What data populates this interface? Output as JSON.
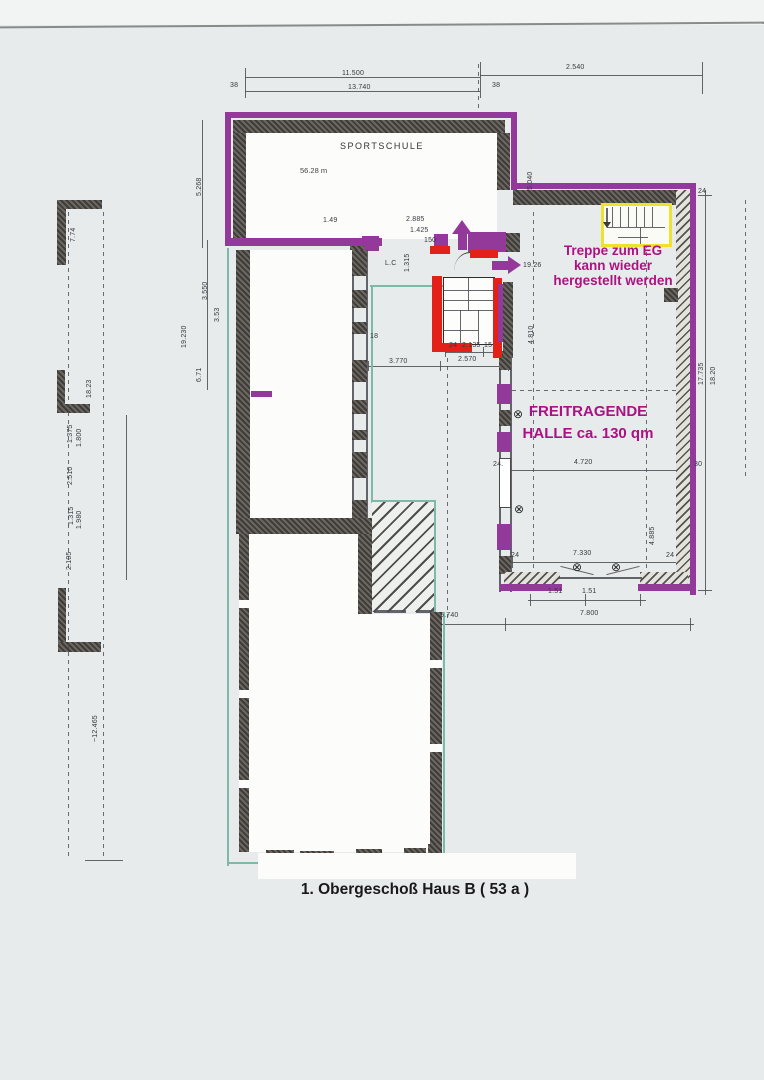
{
  "labels": {
    "room_sportschule": "SPORTSCHULE",
    "room_sportschule_area": "56.28 m",
    "treppe_line1": "Treppe zum EG",
    "treppe_line2": "kann wieder",
    "treppe_line3": "hergestellt werden",
    "halle_line1": "FREITRAGENDE",
    "halle_line2": "HALLE ca. 130 qm",
    "title": "1. Obergeschoß Haus B ( 53 a )"
  },
  "colors": {
    "highlight_purple": "#93399a",
    "annotation_magenta": "#ae1180",
    "highlight_red": "#e32119",
    "highlight_yellow": "#ece22f",
    "outline_teal": "#7db9a9",
    "wall_dark": "#4a4846",
    "paper": "#e8ebec"
  },
  "dimensions": [
    {
      "text": "11.500",
      "x": 342,
      "y": 70
    },
    {
      "text": "13.740",
      "x": 348,
      "y": 84
    },
    {
      "text": "2.540",
      "x": 566,
      "y": 64
    },
    {
      "text": "38",
      "x": 230,
      "y": 82
    },
    {
      "text": "38",
      "x": 492,
      "y": 82
    },
    {
      "text": "5.268",
      "x": 196,
      "y": 196,
      "rot": 1
    },
    {
      "text": "7.74",
      "x": 70,
      "y": 242,
      "rot": 1
    },
    {
      "text": "5.040",
      "x": 527,
      "y": 190,
      "rot": 1
    },
    {
      "text": "1.49",
      "x": 323,
      "y": 217
    },
    {
      "text": "2.885",
      "x": 406,
      "y": 216
    },
    {
      "text": "1.425",
      "x": 410,
      "y": 227
    },
    {
      "text": "150",
      "x": 424,
      "y": 237
    },
    {
      "text": "1.315",
      "x": 404,
      "y": 272,
      "rot": 1
    },
    {
      "text": "L.C",
      "x": 385,
      "y": 260
    },
    {
      "text": "19.26",
      "x": 523,
      "y": 262
    },
    {
      "text": "24",
      "x": 449,
      "y": 342
    },
    {
      "text": "2.135",
      "x": 462,
      "y": 342
    },
    {
      "text": "15",
      "x": 484,
      "y": 342
    },
    {
      "text": "3.770",
      "x": 389,
      "y": 358
    },
    {
      "text": "2.570",
      "x": 458,
      "y": 356
    },
    {
      "text": "18",
      "x": 370,
      "y": 333
    },
    {
      "text": "19.230",
      "x": 181,
      "y": 348,
      "rot": 1
    },
    {
      "text": "3.550",
      "x": 202,
      "y": 300,
      "rot": 1
    },
    {
      "text": "3.53",
      "x": 214,
      "y": 322,
      "rot": 1
    },
    {
      "text": "6.71",
      "x": 196,
      "y": 382,
      "rot": 1
    },
    {
      "text": "18.23",
      "x": 86,
      "y": 398,
      "rot": 1
    },
    {
      "text": "1.375",
      "x": 67,
      "y": 443,
      "rot": 1
    },
    {
      "text": "1.800",
      "x": 76,
      "y": 447,
      "rot": 1
    },
    {
      "text": "2.510",
      "x": 67,
      "y": 485,
      "rot": 1
    },
    {
      "text": "1.315",
      "x": 68,
      "y": 525,
      "rot": 1
    },
    {
      "text": "1.980",
      "x": 76,
      "y": 529,
      "rot": 1
    },
    {
      "text": "2.105",
      "x": 66,
      "y": 570,
      "rot": 1
    },
    {
      "text": "~12.465",
      "x": 92,
      "y": 742,
      "rot": 1
    },
    {
      "text": "17.735",
      "x": 698,
      "y": 385,
      "rot": 1
    },
    {
      "text": "18.20",
      "x": 710,
      "y": 385,
      "rot": 1
    },
    {
      "text": "24",
      "x": 698,
      "y": 188
    },
    {
      "text": "4.810",
      "x": 528,
      "y": 344,
      "rot": 1
    },
    {
      "text": "4.720",
      "x": 574,
      "y": 459
    },
    {
      "text": "24.",
      "x": 493,
      "y": 461
    },
    {
      "text": "30",
      "x": 694,
      "y": 461
    },
    {
      "text": "7.330",
      "x": 573,
      "y": 550
    },
    {
      "text": "24",
      "x": 511,
      "y": 552
    },
    {
      "text": "24",
      "x": 666,
      "y": 552
    },
    {
      "text": "4.885",
      "x": 649,
      "y": 545,
      "rot": 1
    },
    {
      "text": "1.51",
      "x": 548,
      "y": 588
    },
    {
      "text": "1.51",
      "x": 582,
      "y": 588
    },
    {
      "text": "7.800",
      "x": 580,
      "y": 610
    },
    {
      "text": "5.740",
      "x": 440,
      "y": 612
    }
  ],
  "symbols": [
    {
      "glyph": "⊗",
      "x": 513,
      "y": 408
    },
    {
      "glyph": "⊗",
      "x": 514,
      "y": 503
    },
    {
      "glyph": "⊗",
      "x": 572,
      "y": 561
    },
    {
      "glyph": "⊗",
      "x": 611,
      "y": 561
    }
  ]
}
